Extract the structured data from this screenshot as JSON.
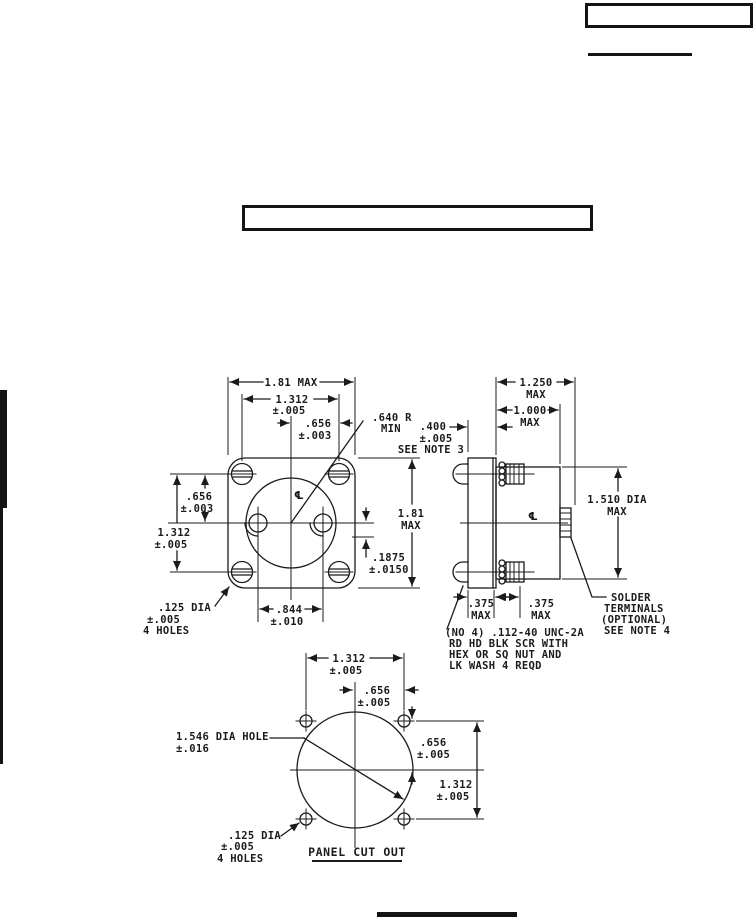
{
  "drawing": {
    "colors": {
      "ink": "#1b1b1b",
      "paper": "#ffffff"
    },
    "front_view": {
      "width_max": "1.81 MAX",
      "hole_spacing_h": "1.312",
      "hole_spacing_h_tol": "±.005",
      "half_spacing_h": ".656",
      "half_spacing_h_tol": "±.003",
      "radius": ".640 R",
      "radius_min": "MIN",
      "half_spacing_v": ".656",
      "half_spacing_v_tol": "±.003",
      "hole_spacing_v": "1.312",
      "hole_spacing_v_tol": "±.005",
      "height_max": "1.81",
      "height_max_unit": "MAX",
      "offset": ".1875",
      "offset_tol": "±.0150",
      "slot_spacing": ".844",
      "slot_spacing_tol": "±.010",
      "mount_hole_dia": ".125 DIA",
      "mount_hole_tol": "±.005",
      "mount_hole_count": "4 HOLES",
      "centerline": "℄"
    },
    "side_view": {
      "depth_max": "1.250",
      "depth_max_unit": "MAX",
      "body_depth": "1.000",
      "body_depth_unit": "MAX",
      "flange_thickness": ".400",
      "flange_thickness_tol": "±.005",
      "flange_thickness_note": "SEE NOTE 3",
      "body_dia": "1.510 DIA",
      "body_dia_unit": "MAX",
      "front_protrusion": ".375",
      "front_protrusion_unit": "MAX",
      "rear_protrusion": ".375",
      "rear_protrusion_unit": "MAX",
      "centerline": "℄",
      "screw_note": [
        "(NO 4) .112-40 UNC-2A",
        "RD HD BLK SCR WITH",
        "HEX OR SQ NUT AND",
        "LK WASH 4 REQD"
      ],
      "solder_note": [
        "SOLDER",
        "TERMINALS",
        "(OPTIONAL)",
        "SEE NOTE 4"
      ]
    },
    "panel_cutout": {
      "hole_spacing_h": "1.312",
      "hole_spacing_h_tol": "±.005",
      "half_spacing_h": ".656",
      "half_spacing_h_tol": "±.005",
      "cutout_dia": "1.546 DIA HOLE",
      "cutout_dia_tol": "±.016",
      "half_spacing_v": ".656",
      "half_spacing_v_tol": "±.005",
      "hole_spacing_v": "1.312",
      "hole_spacing_v_tol": "±.005",
      "mount_hole_dia": ".125 DIA",
      "mount_hole_tol": "±.005",
      "mount_hole_count": "4 HOLES",
      "title": "PANEL CUT OUT"
    }
  }
}
